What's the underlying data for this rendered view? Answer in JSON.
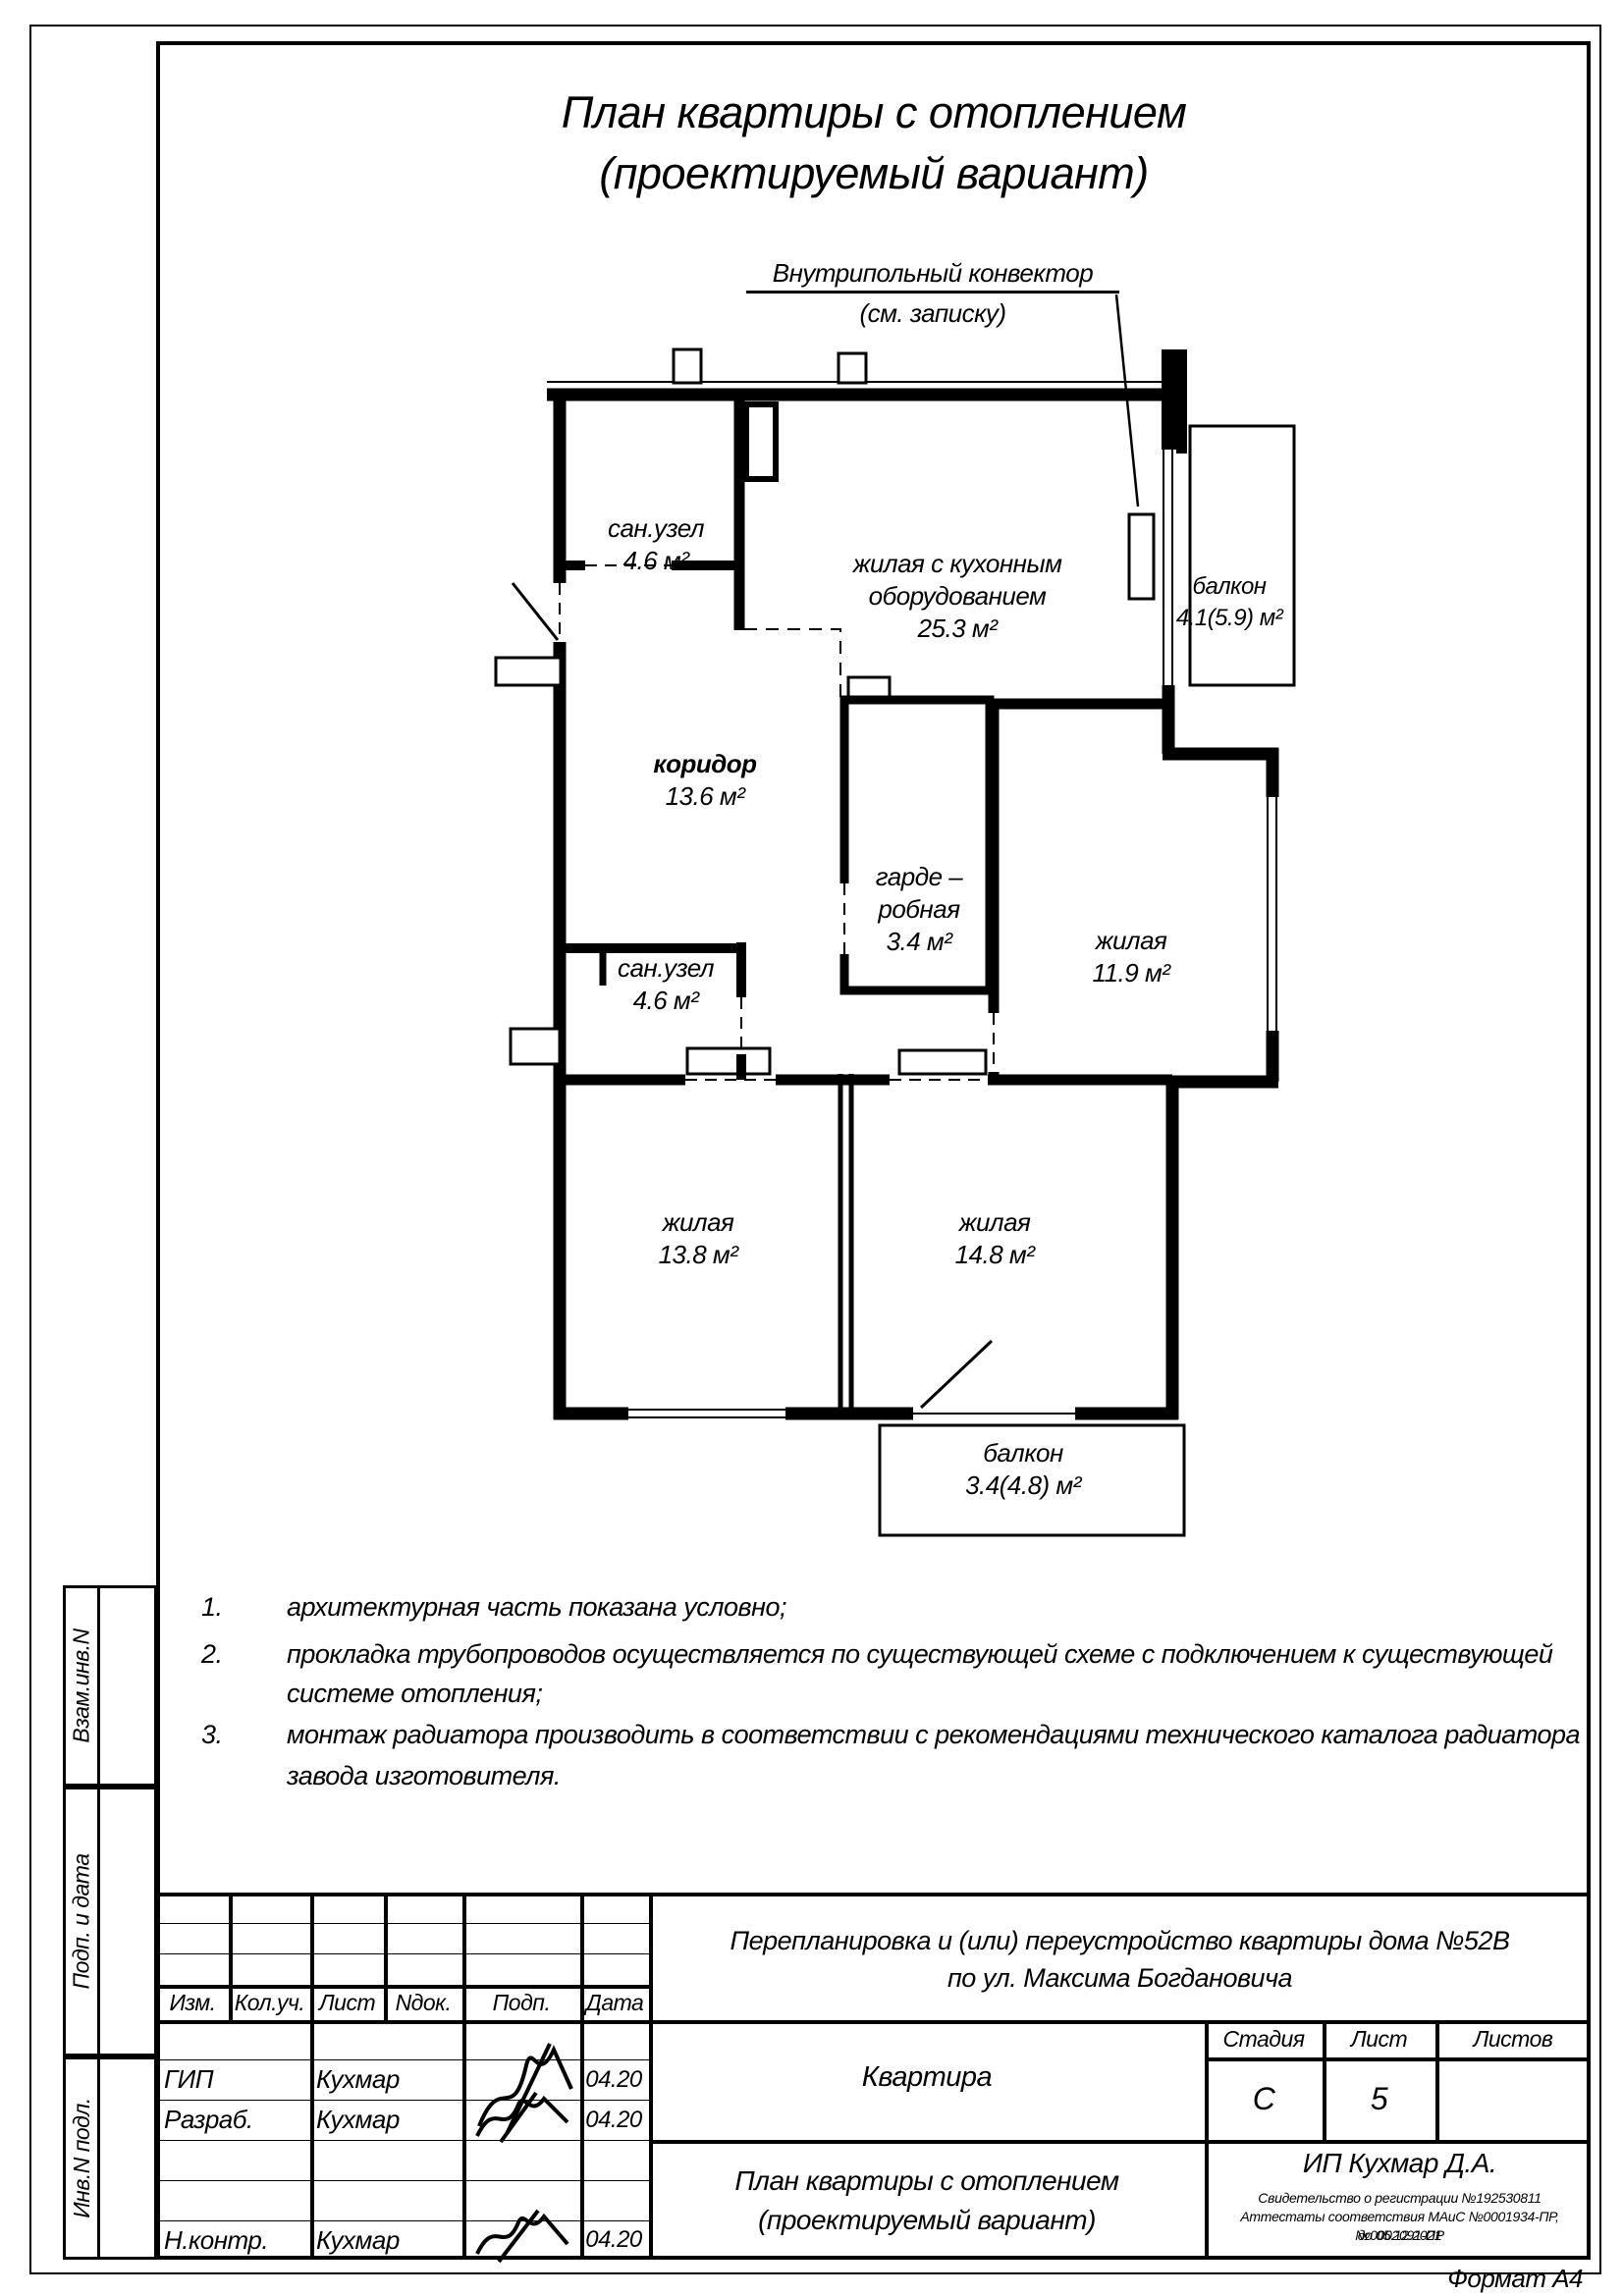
{
  "drawing_title": {
    "line1": "План квартиры с отоплением",
    "line2": "(проектируемый вариант)"
  },
  "callout": {
    "line1": "Внутрипольный конвектор",
    "line2": "(см. записку)"
  },
  "plan": {
    "rooms": {
      "san1": {
        "name": "сан.узел",
        "area": "4.6 м²"
      },
      "living": {
        "name_line1": "жилая с кухонным",
        "name_line2": "оборудованием",
        "area": "25.3 м²"
      },
      "balcony_top": {
        "name": "балкон",
        "area": "4.1(5.9) м²"
      },
      "corridor": {
        "name": "коридор",
        "area": "13.6 м²"
      },
      "wardrobe": {
        "name_line1": "гарде –",
        "name_line2": "робная",
        "area": "3.4 м²"
      },
      "room_11_9": {
        "name": "жилая",
        "area": "11.9 м²"
      },
      "san2": {
        "name": "сан.узел",
        "area": "4.6 м²"
      },
      "room_13_8": {
        "name": "жилая",
        "area": "13.8 м²"
      },
      "room_14_8": {
        "name": "жилая",
        "area": "14.8 м²"
      },
      "balcony_bottom": {
        "name": "балкон",
        "area": "3.4(4.8) м²"
      }
    }
  },
  "notes": {
    "n1_num": "1.",
    "n1_text": "архитектурная часть показана условно;",
    "n2_num": "2.",
    "n2_line1": "прокладка трубопроводов осуществляется по существующей схеме с подключением к существующей",
    "n2_line2": "системе отопления;",
    "n3_num": "3.",
    "n3_line1": "монтаж радиатора производить в соответствии с рекомендациями технического каталога радиатора",
    "n3_line2": "завода изготовителя."
  },
  "side_panel": {
    "box1": "Взам.инв.N",
    "box2": "Подп. и дата",
    "box3": "Инв.N подл."
  },
  "title_block": {
    "cols": {
      "c1": "Изм.",
      "c2": "Кол.уч.",
      "c3": "Лист",
      "c4": "Nдок.",
      "c5": "Подп.",
      "c6": "Дата"
    },
    "row_gip": {
      "role": "ГИП",
      "name": "Кухмар",
      "date": "04.20"
    },
    "row_razrab": {
      "role": "Разраб.",
      "name": "Кухмар",
      "date": "04.20"
    },
    "row_nkontr": {
      "role": "Н.контр.",
      "name": "Кухмар",
      "date": "04.20"
    },
    "project_line1": "Перепланировка и (или) переустройство квартиры дома №52В",
    "project_line2": "по ул. Максима Богдановича",
    "object_name": "Квартира",
    "stage_label": "Стадия",
    "stage_value": "С",
    "sheet_label": "Лист",
    "sheet_value": "5",
    "sheets_label": "Листов",
    "sheets_value": "",
    "doc_line1": "План квартиры с отоплением",
    "doc_line2": "(проектируемый вариант)",
    "company_name": "ИП Кухмар Д.А.",
    "company_cert1": "Свидетельство о регистрации №192530811",
    "company_cert2": "Аттестаты соответствия МАиС №0001934-ПР, №0002091-ПР",
    "company_cert3": "до 05.12.2021"
  },
  "footer": {
    "format": "Формат А4"
  }
}
